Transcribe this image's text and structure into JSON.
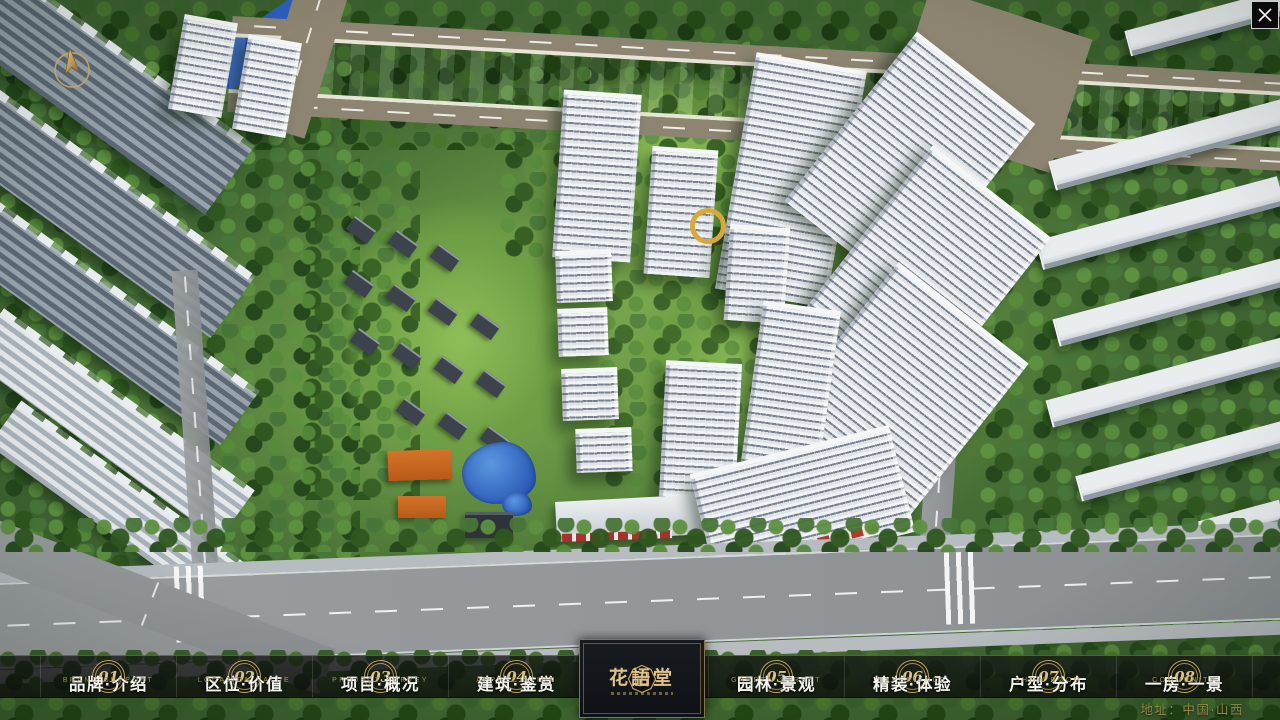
{
  "window": {
    "close_icon": "✕"
  },
  "hud": {
    "compass_icon": "north-arrow"
  },
  "nav": {
    "items": [
      {
        "num": "01",
        "label": "品牌·介绍",
        "sublabel": "BRAND SUPPORT"
      },
      {
        "num": "02",
        "label": "区位·价值",
        "sublabel": "LOCATION VALUE"
      },
      {
        "num": "03",
        "label": "项目·概况",
        "sublabel": "PROJECT SURVEY"
      },
      {
        "num": "04",
        "label": "建筑·鉴赏",
        "sublabel": "APPRECIATION"
      },
      {
        "num": "05",
        "label": "园林·景观",
        "sublabel": "GARDEN STREET"
      },
      {
        "num": "06",
        "label": "精装·体验",
        "sublabel": "EXPERIENCE"
      },
      {
        "num": "07",
        "label": "户型·分布",
        "sublabel": "SHOW ROOM"
      },
      {
        "num": "08",
        "label": "一房·一景",
        "sublabel": "COMMUNITY"
      }
    ]
  },
  "logo": {
    "title": "花語堂"
  },
  "footer": {
    "address": "地址：中国·山西"
  },
  "colors": {
    "gold_accent": "#c9ad6b",
    "logo_gold": "#dfc287",
    "water_blue": "#2b5fc0",
    "nav_bg": "rgba(13,15,14,0.78)"
  }
}
